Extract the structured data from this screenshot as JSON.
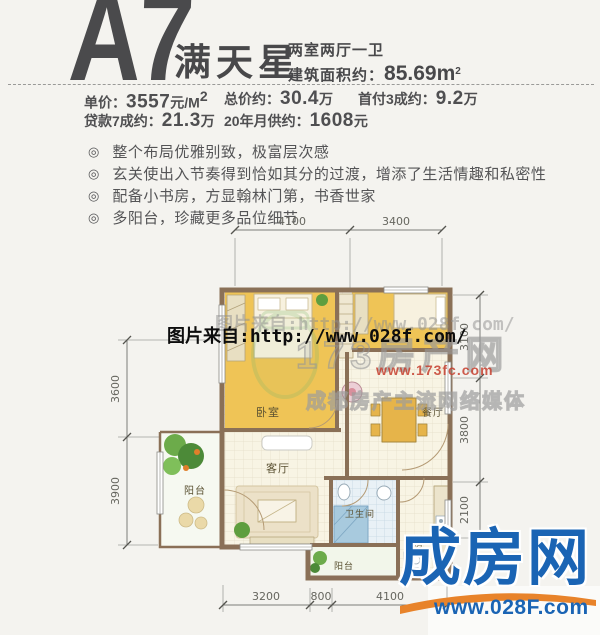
{
  "header": {
    "code": "A7",
    "name": "满天星",
    "layout_type": "两室两厅一卫",
    "area_label": "建筑面积约：",
    "area_value": "85.69m",
    "area_sup": "2"
  },
  "pricing": {
    "items": [
      {
        "label": "单价：",
        "value": "3557",
        "unit": "元/M",
        "sup": "2"
      },
      {
        "label": "总价约：",
        "value": "30.4",
        "unit": "万"
      },
      {
        "label": "首付3成约：",
        "value": "9.2",
        "unit": "万"
      },
      {
        "label": "贷款7成约：",
        "value": "21.3",
        "unit": "万"
      },
      {
        "label": "20年月供约：",
        "value": "1608",
        "unit": "元"
      }
    ]
  },
  "features": {
    "marker": "◎",
    "items": [
      "整个布局优雅别致，极富层次感",
      "玄关使出入节奏得到恰如其分的过渡，增添了生活情趣和私密性",
      "配备小书房，方显翰林门第，书香世家",
      "多阳台，珍藏更多品位细节"
    ]
  },
  "plan": {
    "rooms": {
      "bedroom": "卧室",
      "dining": "餐厅",
      "living": "客厅",
      "balcony_left": "阳台",
      "bathroom": "卫生间",
      "kitchen": "厨房",
      "balcony_bottom": "阳台"
    },
    "dims": {
      "top": [
        "4100",
        "3400"
      ],
      "left": [
        "3600",
        "3900"
      ],
      "right": [
        "3100",
        "3800",
        "2100"
      ],
      "bottom": [
        "3200",
        "800",
        "4100"
      ]
    }
  },
  "watermarks": {
    "photo_source": "图片来自:http://www.028f.com/",
    "site_name": "173房产网",
    "site_url": "www.173fc.com",
    "slogan": "成都房产主流网络媒体"
  },
  "logo": {
    "name": "成房网",
    "url": "www.028F.com"
  },
  "colors": {
    "brand_blue": "#1a64b4",
    "brand_orange": "#e8832a",
    "wall_brown": "#8a7057",
    "room_yellow": "#efc456",
    "tile_blue": "#a8cade",
    "heading_gray": "#4a4a4c"
  }
}
